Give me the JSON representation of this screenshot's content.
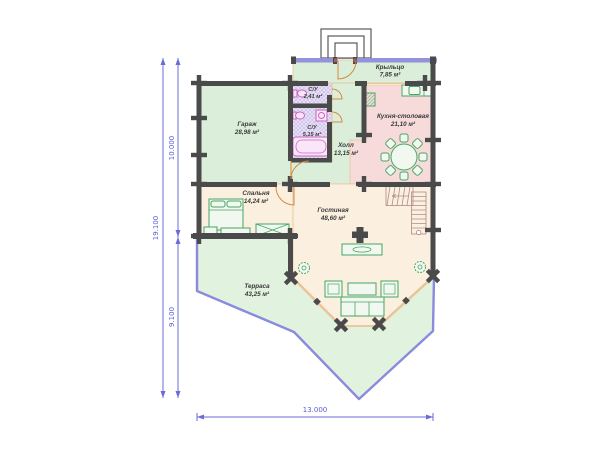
{
  "rooms": {
    "garage": {
      "name": "Гараж",
      "area": "28,98 м²"
    },
    "wc_small": {
      "name": "С/У",
      "area": "2,41 м²"
    },
    "wc_large": {
      "name": "С/У",
      "area": "5,15 м²"
    },
    "hall": {
      "name": "Холл",
      "area": "13,15 м²"
    },
    "porch": {
      "name": "Крыльцо",
      "area": "7,85 м²"
    },
    "kitchen": {
      "name": "Кухня-столовая",
      "area": "21,10 м²"
    },
    "bedroom": {
      "name": "Спальня",
      "area": "14,24 м²"
    },
    "living": {
      "name": "Гостиная",
      "area": "48,60 м²"
    },
    "terrace": {
      "name": "Терраса",
      "area": "43,25 м²"
    }
  },
  "dimensions": {
    "overall_height": "19.100",
    "upper_section": "10.000",
    "lower_section": "9.100",
    "overall_width": "13.000"
  },
  "colors": {
    "wall": "#4a4a4a",
    "room_green": "#daeeda",
    "terrace_green": "#e1f2df",
    "kitchen_pink": "#f7dbdb",
    "floor_cream": "#fbf0df",
    "bath_lavender": "#ece6f8",
    "furniture_green": "#4aa564",
    "dimension_blue": "#6b6bd9",
    "terrace_outline": "#8a8ade",
    "door_arc_orange": "#d8893f",
    "fixture_pink": "#c966c3",
    "porch_glazing_blue": "#9393dc"
  }
}
